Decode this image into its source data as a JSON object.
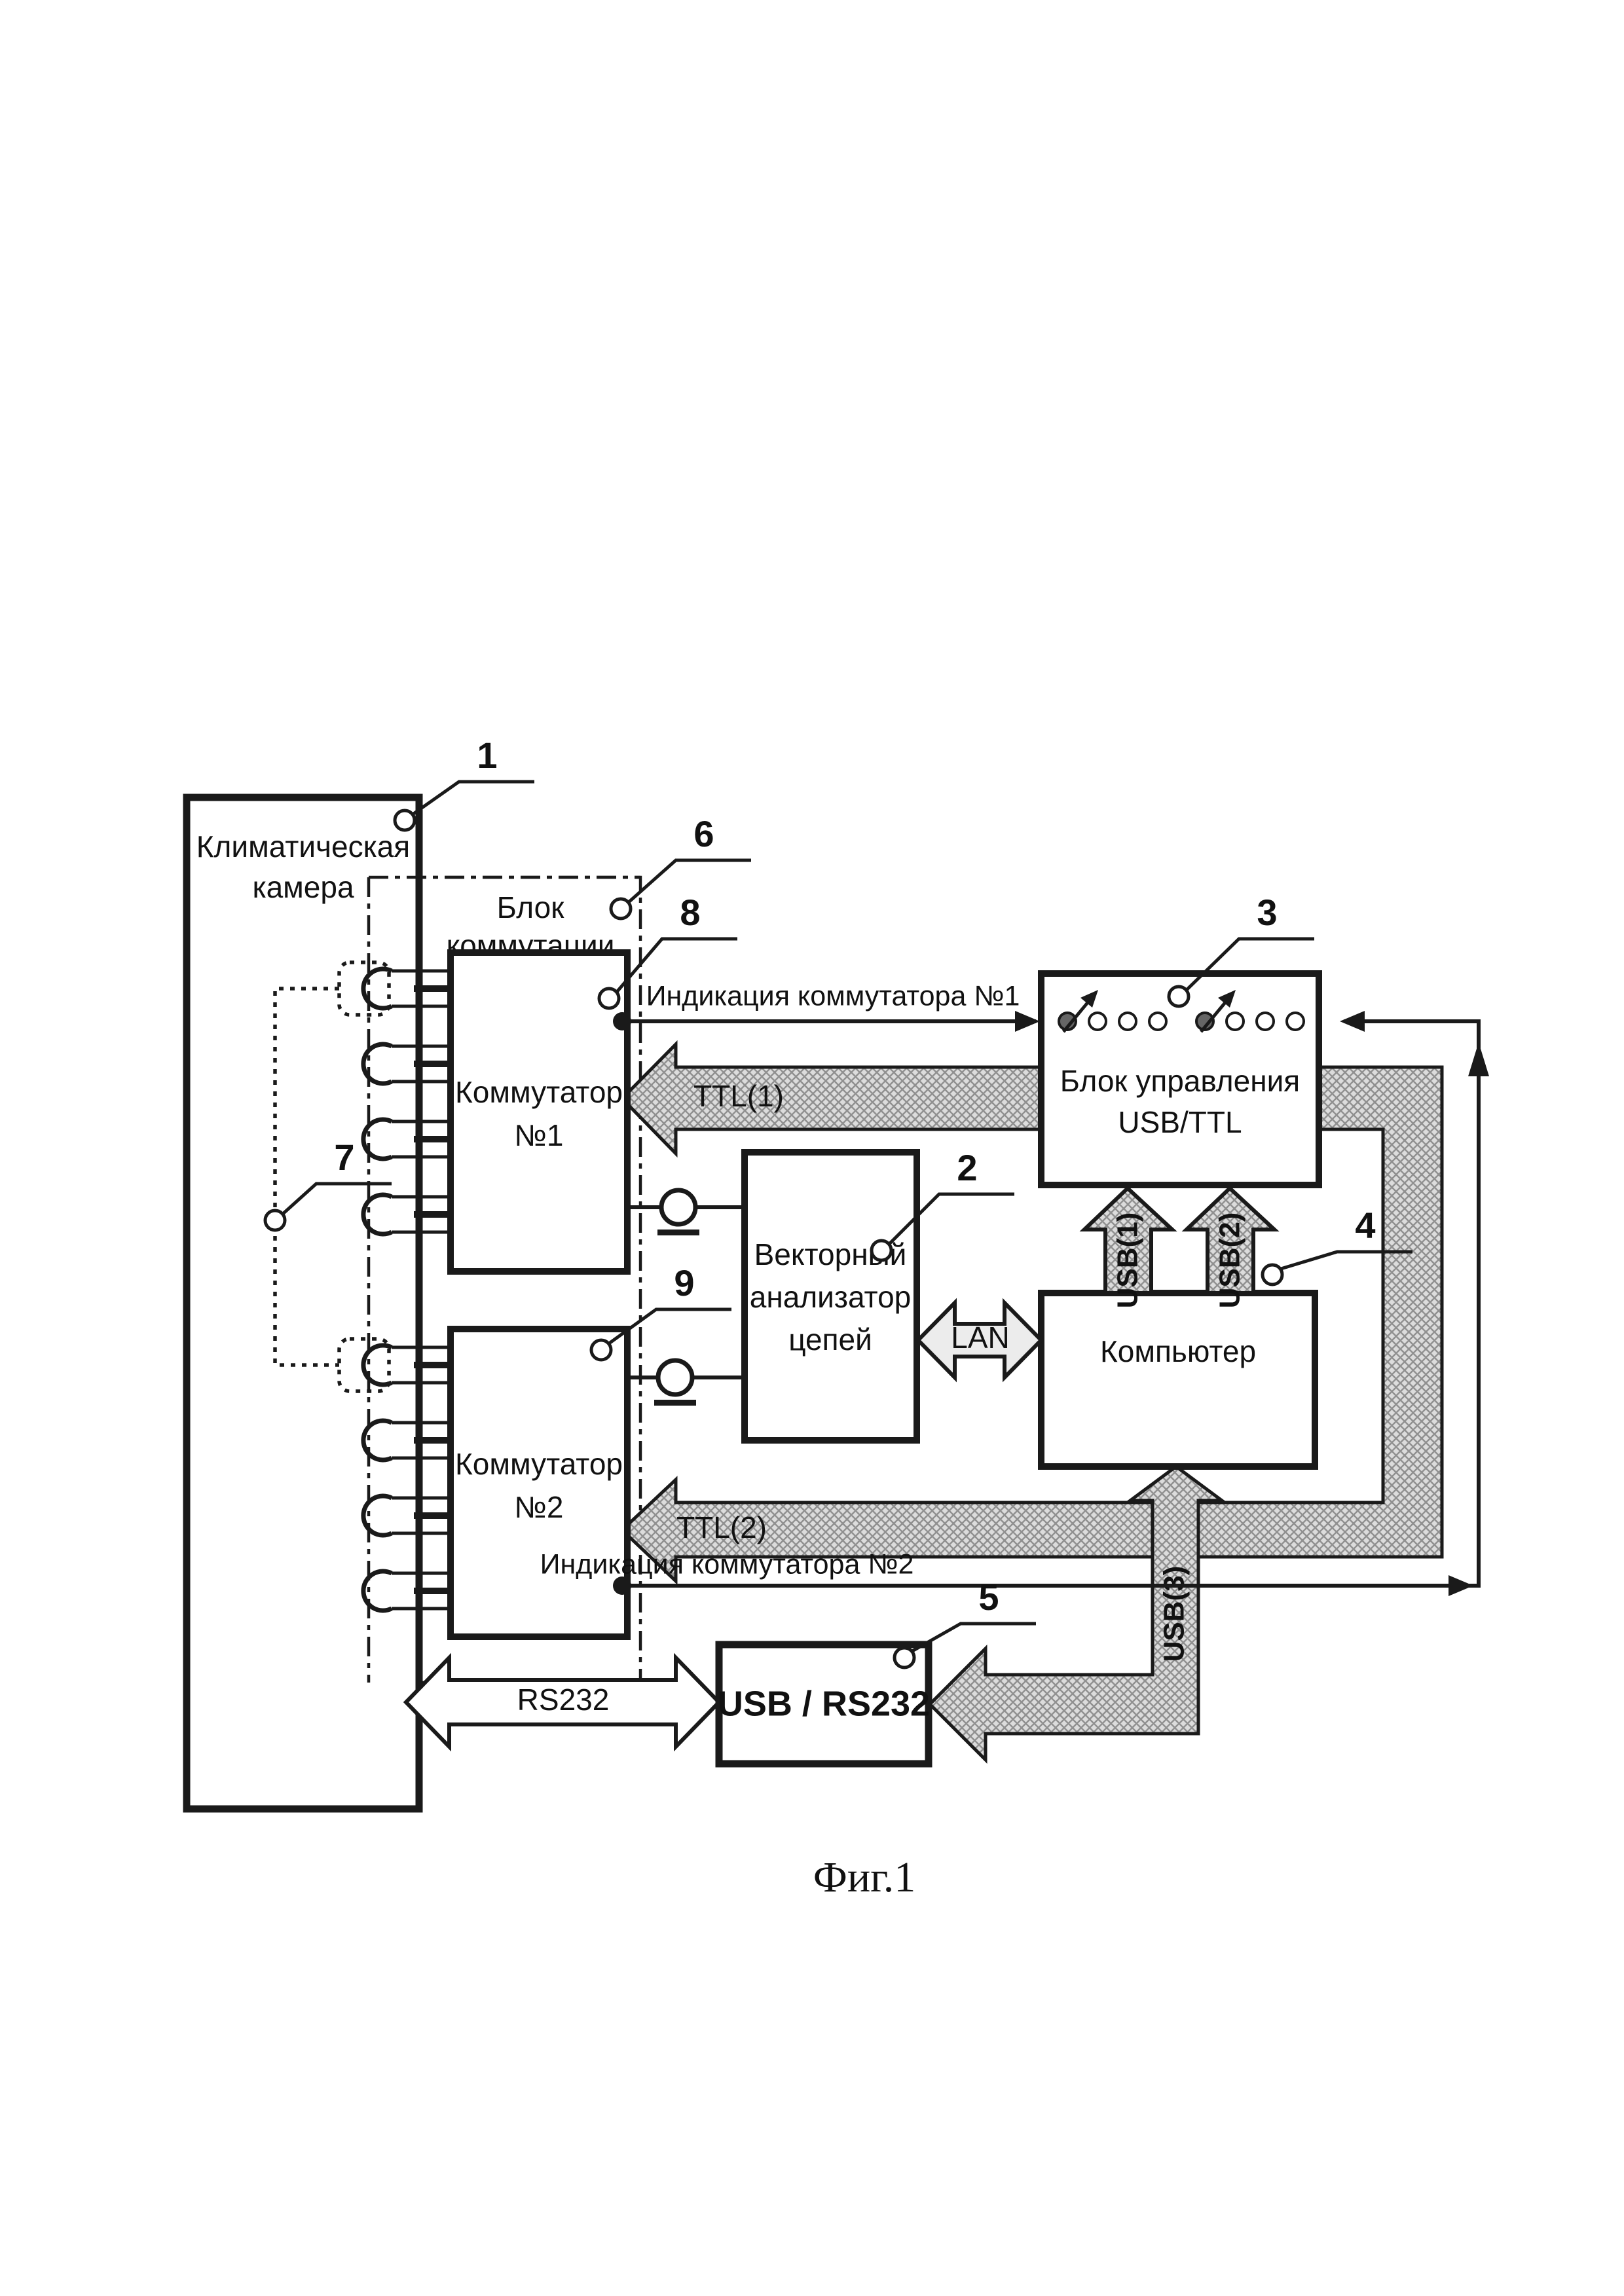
{
  "figure": {
    "caption": "Фиг.1"
  },
  "blocks": {
    "chamber": {
      "line1": "Климатическая",
      "line2": "камера"
    },
    "komm_unit": {
      "line1": "Блок",
      "line2": "коммутации"
    },
    "switch1": {
      "line1": "Коммутатор",
      "line2": "№1"
    },
    "switch2": {
      "line1": "Коммутатор",
      "line2": "№2"
    },
    "vna": {
      "line1": "Векторный",
      "line2": "анализатор",
      "line3": "цепей"
    },
    "control": {
      "line1": "Блок управления",
      "line2": "USB/TTL"
    },
    "computer": {
      "label": "Компьютер"
    },
    "usb_rs232": {
      "label": "USB / RS232"
    }
  },
  "signals": {
    "indication1": "Индикация коммутатора №1",
    "indication2": "Индикация коммутатора №2",
    "ttl1": "TTL(1)",
    "ttl2": "TTL(2)",
    "usb1": "USB(1)",
    "usb2": "USB(2)",
    "usb3": "USB(3)",
    "lan": "LAN",
    "rs232": "RS232"
  },
  "callouts": {
    "c1": "1",
    "c2": "2",
    "c3": "3",
    "c4": "4",
    "c5": "5",
    "c6": "6",
    "c7": "7",
    "c8": "8",
    "c9": "9"
  },
  "leds": {
    "count": 8,
    "on_indices": [
      1,
      5
    ]
  },
  "colors": {
    "ink": "#1a1a1a",
    "hatch_fill": "#dcdcdc",
    "hatch_line": "#909090",
    "lan_fill": "#ececec",
    "led_on": "#666666"
  }
}
